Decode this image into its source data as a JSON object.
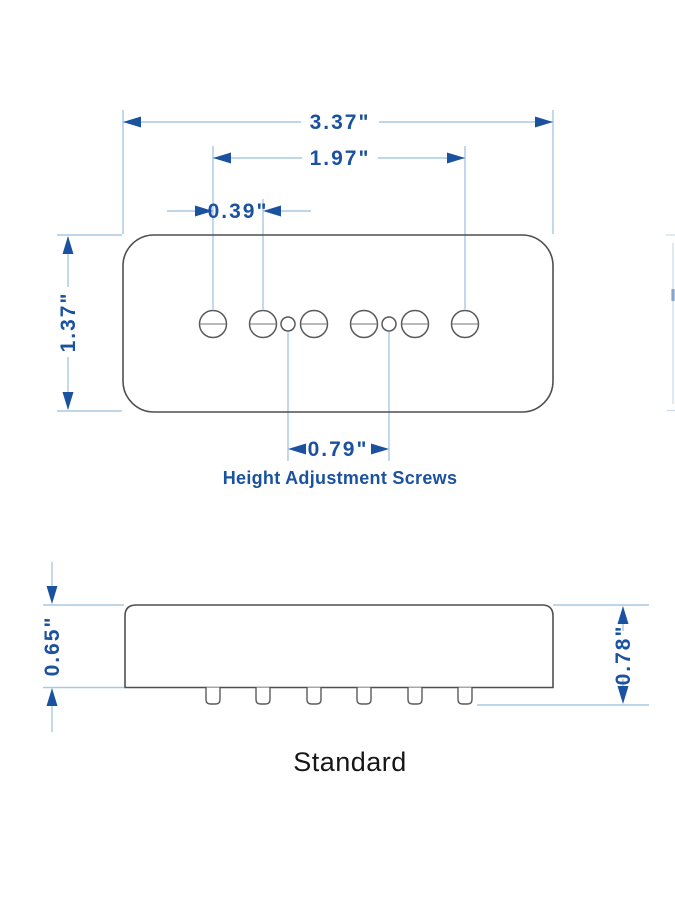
{
  "diagram": {
    "variant_label": "Standard",
    "annotation": "Height Adjustment Screws",
    "top_view": {
      "overall_width": "3.37\"",
      "pole_span": "1.97\"",
      "pole_spacing": "0.39\"",
      "body_depth": "1.37\"",
      "adjust_screw_spacing": "0.79\""
    },
    "side_view": {
      "body_height": "0.65\"",
      "overall_height": "0.78\""
    },
    "colors": {
      "dimension_line": "#a8c8e3",
      "dimension_text": "#1b52a0",
      "outline_gray": "#4f4f4f",
      "label_black": "#161616"
    }
  }
}
